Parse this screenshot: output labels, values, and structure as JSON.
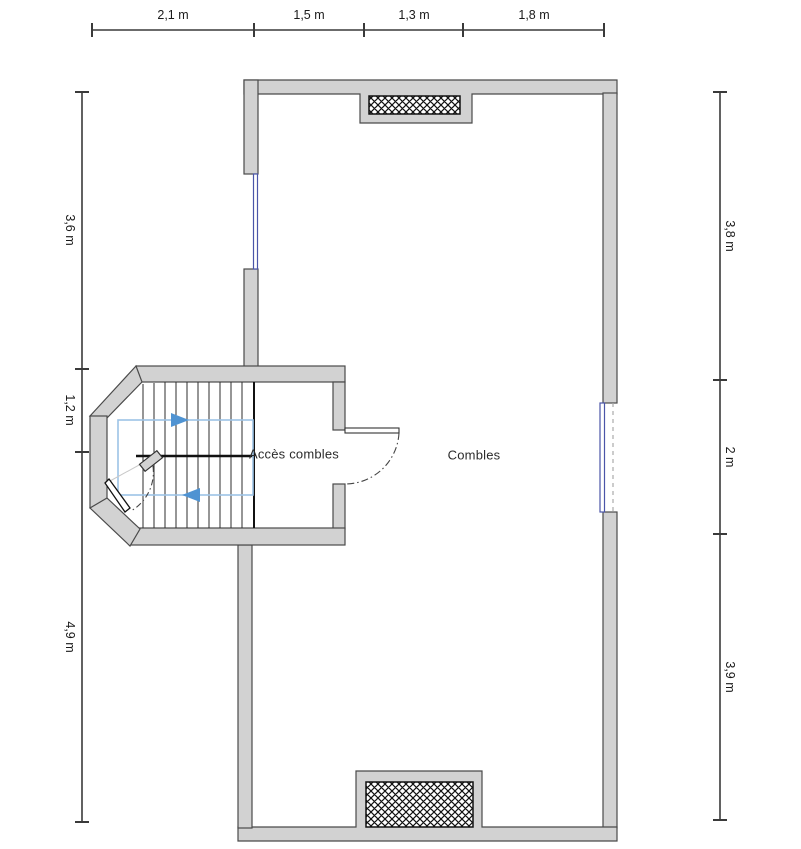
{
  "plan": {
    "rooms": [
      {
        "name": "Accès combles"
      },
      {
        "name": "Combles"
      }
    ],
    "features": {
      "stairs": "staircase-with-direction-arrows",
      "vents": [
        "hatched-opening-top-wall",
        "hatched-opening-bottom-wall"
      ],
      "windows": [
        "left-wall-window",
        "right-wall-window"
      ],
      "doors": [
        "staircase-door-to-combles",
        "staircase-bay-entry-door"
      ]
    }
  },
  "dimensions": {
    "top": [
      {
        "label": "2,1 m"
      },
      {
        "label": "1,5 m"
      },
      {
        "label": "1,3 m"
      },
      {
        "label": "1,8 m"
      }
    ],
    "left": [
      {
        "label": "3,6 m"
      },
      {
        "label": "1,2 m"
      },
      {
        "label": "4,9 m"
      }
    ],
    "right": [
      {
        "label": "3,8 m"
      },
      {
        "label": "2 m"
      },
      {
        "label": "3,9 m"
      }
    ]
  },
  "colors": {
    "wall_fill": "#d2d2d2",
    "wall_outline": "#4a4a4a",
    "window_blue": "#4a55a8",
    "path_blue": "#9dc3e6",
    "arrow_blue": "#4f93d2",
    "dimension_line": "#3a3a3a",
    "hatch": "#111111"
  }
}
